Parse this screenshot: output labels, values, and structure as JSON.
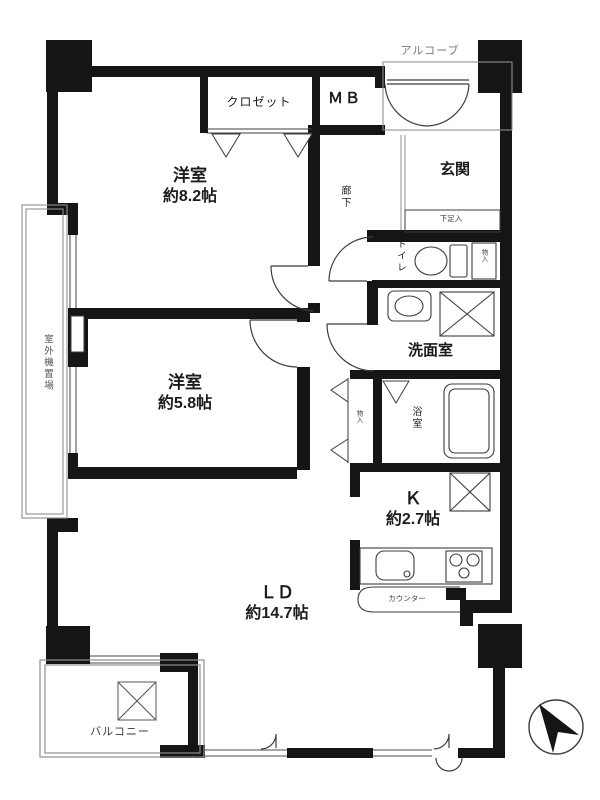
{
  "colors": {
    "wall": "#151515",
    "line": "#3c3c3c",
    "light_line": "#8f8f8f"
  },
  "rooms": {
    "bedroom1": {
      "name": "洋室",
      "size": "約8.2帖"
    },
    "bedroom2": {
      "name": "洋室",
      "size": "約5.8帖"
    },
    "living_dining": {
      "name": "ＬＤ",
      "size": "約14.7帖"
    },
    "kitchen": {
      "name": "Ｋ",
      "size": "約2.7帖"
    },
    "entrance": {
      "name": "玄関"
    },
    "hallway": {
      "name": "廊下"
    },
    "toilet": {
      "name": "トイレ"
    },
    "washroom": {
      "name": "洗面室"
    },
    "bathroom": {
      "name": "浴室"
    },
    "closet": {
      "name": "クロゼット"
    },
    "meter_box": {
      "name": "ＭＢ"
    },
    "alcove": {
      "name": "アルコーブ"
    },
    "balcony": {
      "name": "バルコニー"
    },
    "counter": {
      "name": "カウンター"
    },
    "shoe_cabinet": {
      "name": "下足入"
    },
    "storage_by_toilet": {
      "name": "物入"
    },
    "storage_by_bath": {
      "name": "物入"
    },
    "outdoor_unit_space": {
      "name": "室外機置場"
    }
  }
}
